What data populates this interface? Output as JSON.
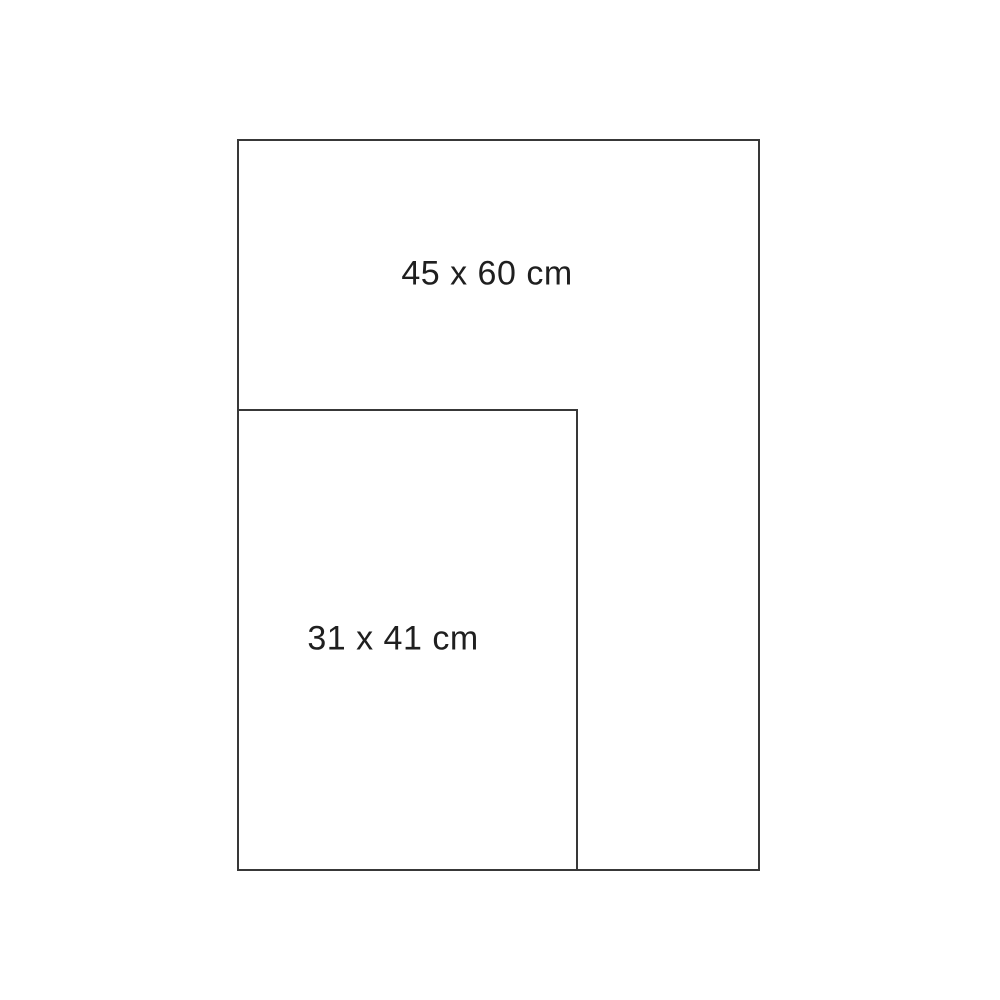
{
  "diagram": {
    "type": "size-comparison",
    "background_color": "#ffffff",
    "stroke_color": "#383838",
    "text_color": "#1f1f1f",
    "rectangles": [
      {
        "label": "45 x 60 cm",
        "width_cm": 45,
        "height_cm": 60,
        "position": "large outer rectangle"
      },
      {
        "label": "31 x 41 cm",
        "width_cm": 31,
        "height_cm": 41,
        "position": "smaller rectangle nested at bottom-left, sharing left and bottom edges"
      }
    ]
  }
}
